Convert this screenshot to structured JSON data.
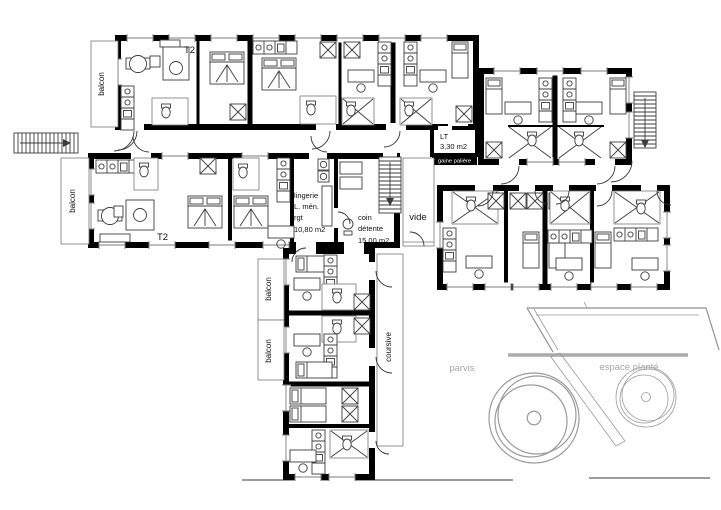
{
  "colors": {
    "wall": "#000000",
    "furniture": "#3c3c3c",
    "site_lines": "#8f8f8f",
    "site_text": "#a6a6a6",
    "band_bg": "#000000",
    "band_text": "#ffffff"
  },
  "labels": {
    "balcony_top": "balcon",
    "balcony_mid": "balcon",
    "balcony_south_upper": "balcon",
    "balcony_south_lower": "balcon",
    "t2_upper": "T2",
    "t2_mid": "T2",
    "lt": {
      "name": "LT",
      "area": "3,30 m2"
    },
    "gaine_paliere": "gaine palière",
    "lingerie": {
      "l1": "lingerie",
      "l2": "L. mén.",
      "l3": "rgt",
      "l4": "10,80 m2"
    },
    "coin_detente": {
      "l1": "coin",
      "l2": "détente",
      "l3": "15,00 m2"
    },
    "vide": "vide",
    "coursive": "coursive",
    "parvis": "parvis",
    "espace_plante": "espace planté"
  }
}
